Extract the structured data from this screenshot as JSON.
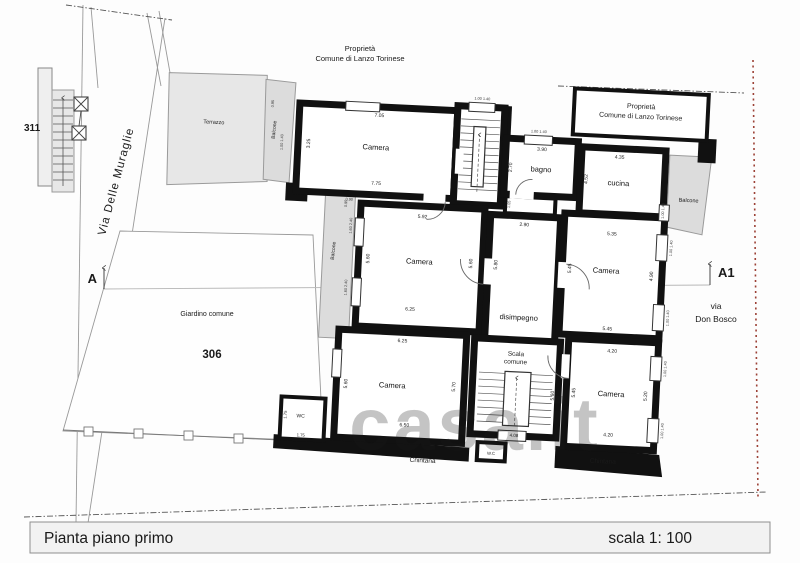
{
  "title_bar": {
    "title": "Pianta piano primo",
    "scale_label": "scala 1: 100"
  },
  "streets": {
    "left": "Via Delle Muraglie",
    "right_line1": "via",
    "right_line2": "Don Bosco"
  },
  "section": {
    "left": "A",
    "right": "A1"
  },
  "parcels": {
    "left_building": "311",
    "garden_number": "306"
  },
  "areas": {
    "garden": "Giardino comune",
    "terrace": "Terrazzo",
    "balcony": "Balcone",
    "alley": "Chintana",
    "property_note_line1": "Proprietà",
    "property_note_line2": "Comune di Lanzo Torinese"
  },
  "rooms": {
    "camera_nw": {
      "label": "Camera",
      "dim_top": "7.05",
      "dim_bottom": "7.75",
      "dim_left": "3.25"
    },
    "bagno": {
      "label": "bagno",
      "dim_top": "3.90",
      "dim_left": "2.70"
    },
    "cucina": {
      "label": "cucina",
      "dim_top": "4.35",
      "dim_left": "4.52"
    },
    "camera_w": {
      "label": "Camera",
      "dim_top": "5.92",
      "dim_bottom": "6.25",
      "dim_left": "5.60",
      "dim_right": "5.60"
    },
    "disimpegno": {
      "label": "disimpegno",
      "dim_top": "2.90",
      "dim_left": "5.80",
      "dim_passage": "1.05"
    },
    "camera_e": {
      "label": "Camera",
      "dim_top": "5.35",
      "dim_bottom": "5.45",
      "dim_left": "5.45",
      "dim_right": "4.90"
    },
    "camera_sw": {
      "label": "Camera",
      "dim_top": "6.25",
      "dim_bottom": "6.50",
      "dim_left": "5.60",
      "dim_right": "5.70"
    },
    "scala": {
      "label_line1": "Scala",
      "label_line2": "comune",
      "dim_right": "5.60",
      "dim_bottom": "4.08"
    },
    "camera_se": {
      "label": "Camera",
      "dim_top": "4.20",
      "dim_bottom": "4.20",
      "dim_left": "5.45",
      "dim_right": "5.20"
    },
    "wc": {
      "label": "WC",
      "dim_w": "1.75",
      "dim_h": "1.75"
    },
    "wc_small": {
      "label": "W.C"
    }
  },
  "small_dims": {
    "window": "1.00 1.40",
    "balcony_depth": "0.95",
    "balcony_window": "1.60 2.40",
    "door": "0.90"
  },
  "watermark": {
    "text": "casa.it"
  }
}
